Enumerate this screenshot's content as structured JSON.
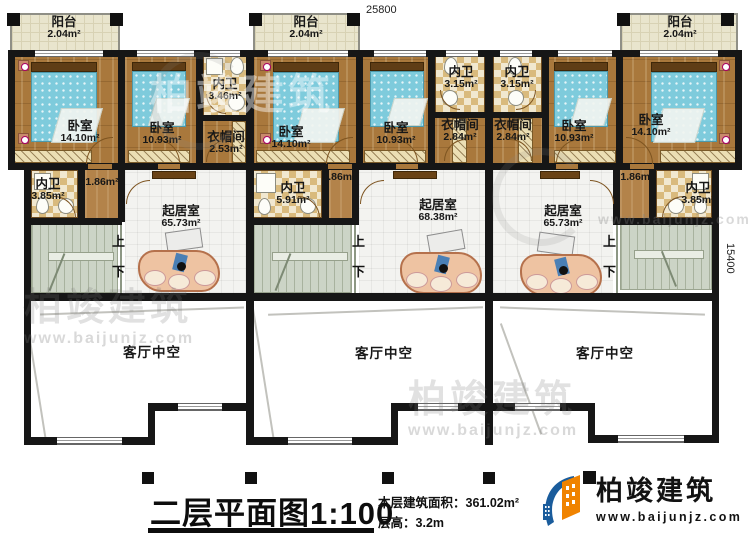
{
  "dimensions": {
    "top_width": "25800",
    "right_height": "15400"
  },
  "rooms": {
    "balcony_l": {
      "name": "阳台",
      "area": "2.04m²"
    },
    "balcony_m": {
      "name": "阳台",
      "area": "2.04m²"
    },
    "balcony_r": {
      "name": "阳台",
      "area": "2.04m²"
    },
    "bedroom_l1": {
      "name": "卧室",
      "area": "14.10m²"
    },
    "bedroom_l2": {
      "name": "卧室",
      "area": "10.93m²"
    },
    "bath_l_top": {
      "name": "内卫",
      "area": "3.46m²"
    },
    "closet_l": {
      "name": "衣帽间",
      "area": "2.53m²"
    },
    "bedroom_m1": {
      "name": "卧室",
      "area": "14.10m²"
    },
    "bedroom_m2": {
      "name": "卧室",
      "area": "10.93m²"
    },
    "bath_m_top": {
      "name": "内卫",
      "area": "3.15m²"
    },
    "closet_m": {
      "name": "衣帽间",
      "area": "2.84m²"
    },
    "bath_r_top": {
      "name": "内卫",
      "area": "3.15m²"
    },
    "closet_r": {
      "name": "衣帽间",
      "area": "2.84m²"
    },
    "bedroom_r2": {
      "name": "卧室",
      "area": "10.93m²"
    },
    "bedroom_r1": {
      "name": "卧室",
      "area": "14.10m²"
    },
    "bath_l": {
      "name": "内卫",
      "area": "3.85m²"
    },
    "bath_m": {
      "name": "内卫",
      "area": "5.91m²"
    },
    "bath_r": {
      "name": "内卫",
      "area": "3.85m²"
    },
    "hall_l": {
      "area": "1.86m²"
    },
    "hall_m": {
      "area": "1.86m²"
    },
    "hall_r": {
      "area": "1.86m²"
    },
    "living_l": {
      "name": "起居室",
      "area": "65.73m²"
    },
    "living_m": {
      "name": "起居室",
      "area": "68.38m²"
    },
    "living_r": {
      "name": "起居室",
      "area": "65.73m²"
    },
    "void_l": {
      "name": "客厅中空"
    },
    "void_m": {
      "name": "客厅中空"
    },
    "void_r": {
      "name": "客厅中空"
    }
  },
  "stairs": {
    "up": "上",
    "down": "下"
  },
  "titleblock": {
    "title": "二层平面图",
    "scale": "1:100",
    "area_label": "本层建筑面积：",
    "area_value": "361.02m²",
    "floor_height_label": "层高：",
    "floor_height_value": "3.2m"
  },
  "logo": {
    "company": "柏竣建筑",
    "website": "www.baijunjz.com"
  },
  "watermark": {
    "company": "柏竣建筑",
    "website": "www.baijunjz.com"
  }
}
